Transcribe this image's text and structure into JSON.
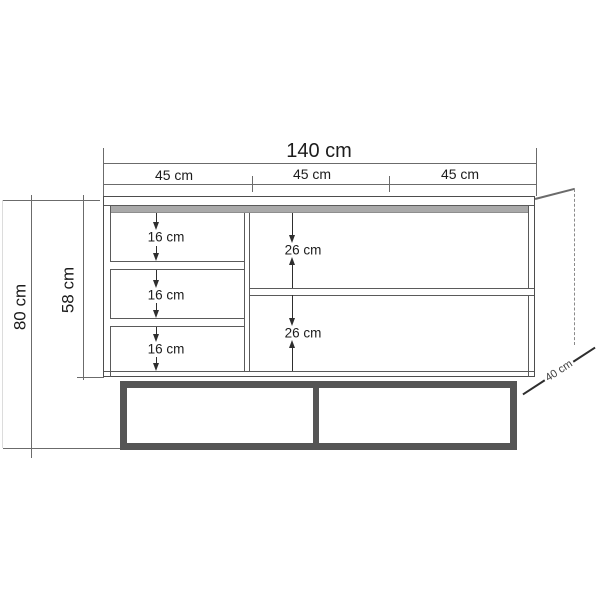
{
  "labels": {
    "total_width": "140 cm",
    "sections": [
      "45 cm",
      "45 cm",
      "45 cm"
    ],
    "total_height": "80 cm",
    "body_height": "58 cm",
    "left_gaps": [
      "16 cm",
      "16 cm",
      "16 cm"
    ],
    "right_gaps": [
      "26 cm",
      "26 cm"
    ],
    "depth": "40 cm"
  },
  "colors": {
    "outline": "#4d4d4d",
    "dimension_line": "#6b6b6b",
    "top_strip": "#a9a9a9",
    "base_frame": "#555555",
    "text": "#1c1c1c",
    "background": "#ffffff"
  }
}
